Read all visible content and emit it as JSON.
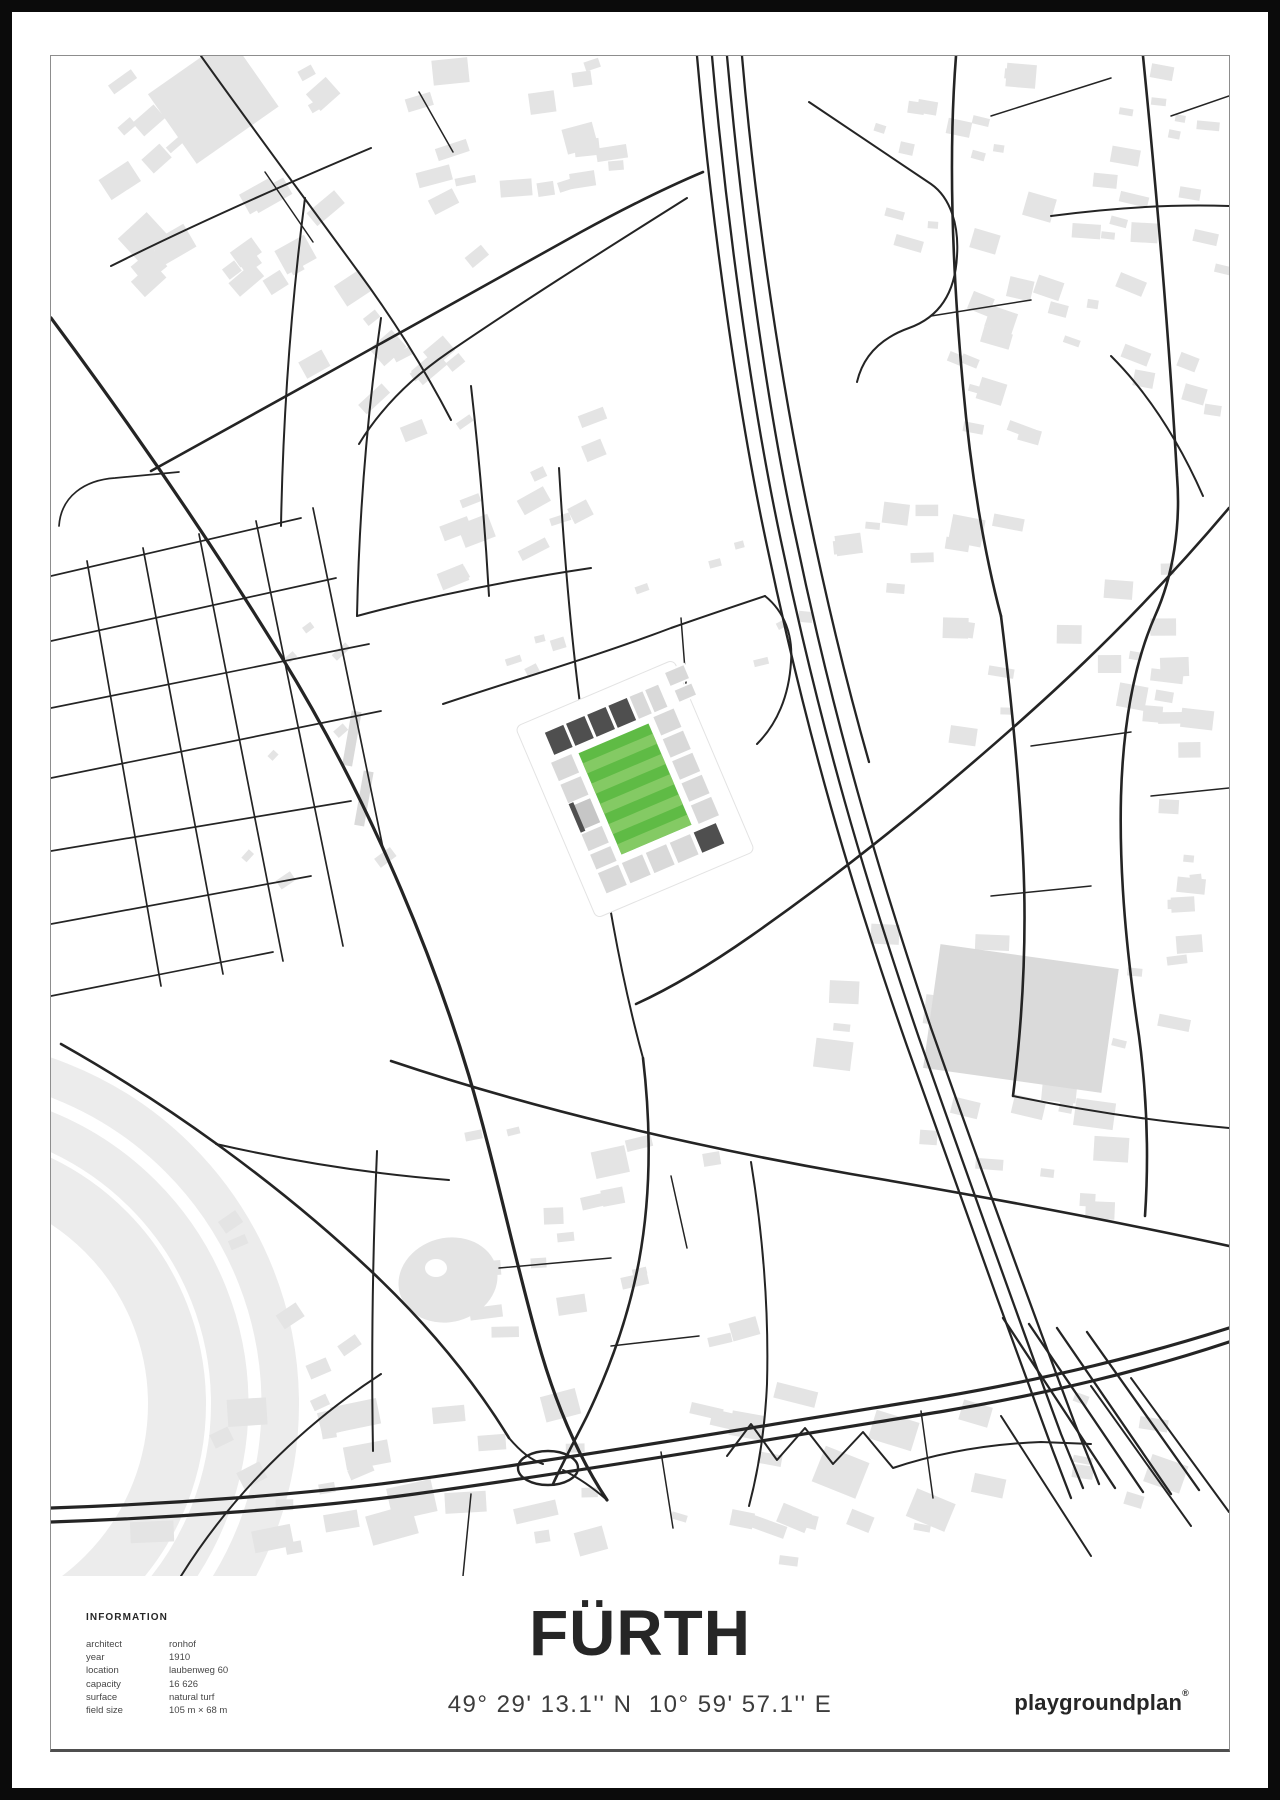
{
  "info": {
    "heading": "INFORMATION",
    "rows": [
      {
        "label": "architect",
        "value": "ronhof"
      },
      {
        "label": "year",
        "value": "1910"
      },
      {
        "label": "location",
        "value": "laubenweg 60"
      },
      {
        "label": "capacity",
        "value": "16 626"
      },
      {
        "label": "surface",
        "value": "natural turf"
      },
      {
        "label": "field size",
        "value": "105 m × 68 m"
      }
    ]
  },
  "title": "FÜRTH",
  "coordinates": "49° 29' 13.1'' N  10° 59' 57.1'' E",
  "brand": {
    "name": "playgroundplan",
    "mark": "®"
  },
  "map": {
    "colors": {
      "street": "#242424",
      "building": "#e4e4e4",
      "track": "#ececec",
      "pitch": "#5fbb45",
      "pitch-stripe": "#84ca64",
      "stand-dark": "#4f4f4f",
      "stand-light": "#d9d9d9"
    }
  }
}
